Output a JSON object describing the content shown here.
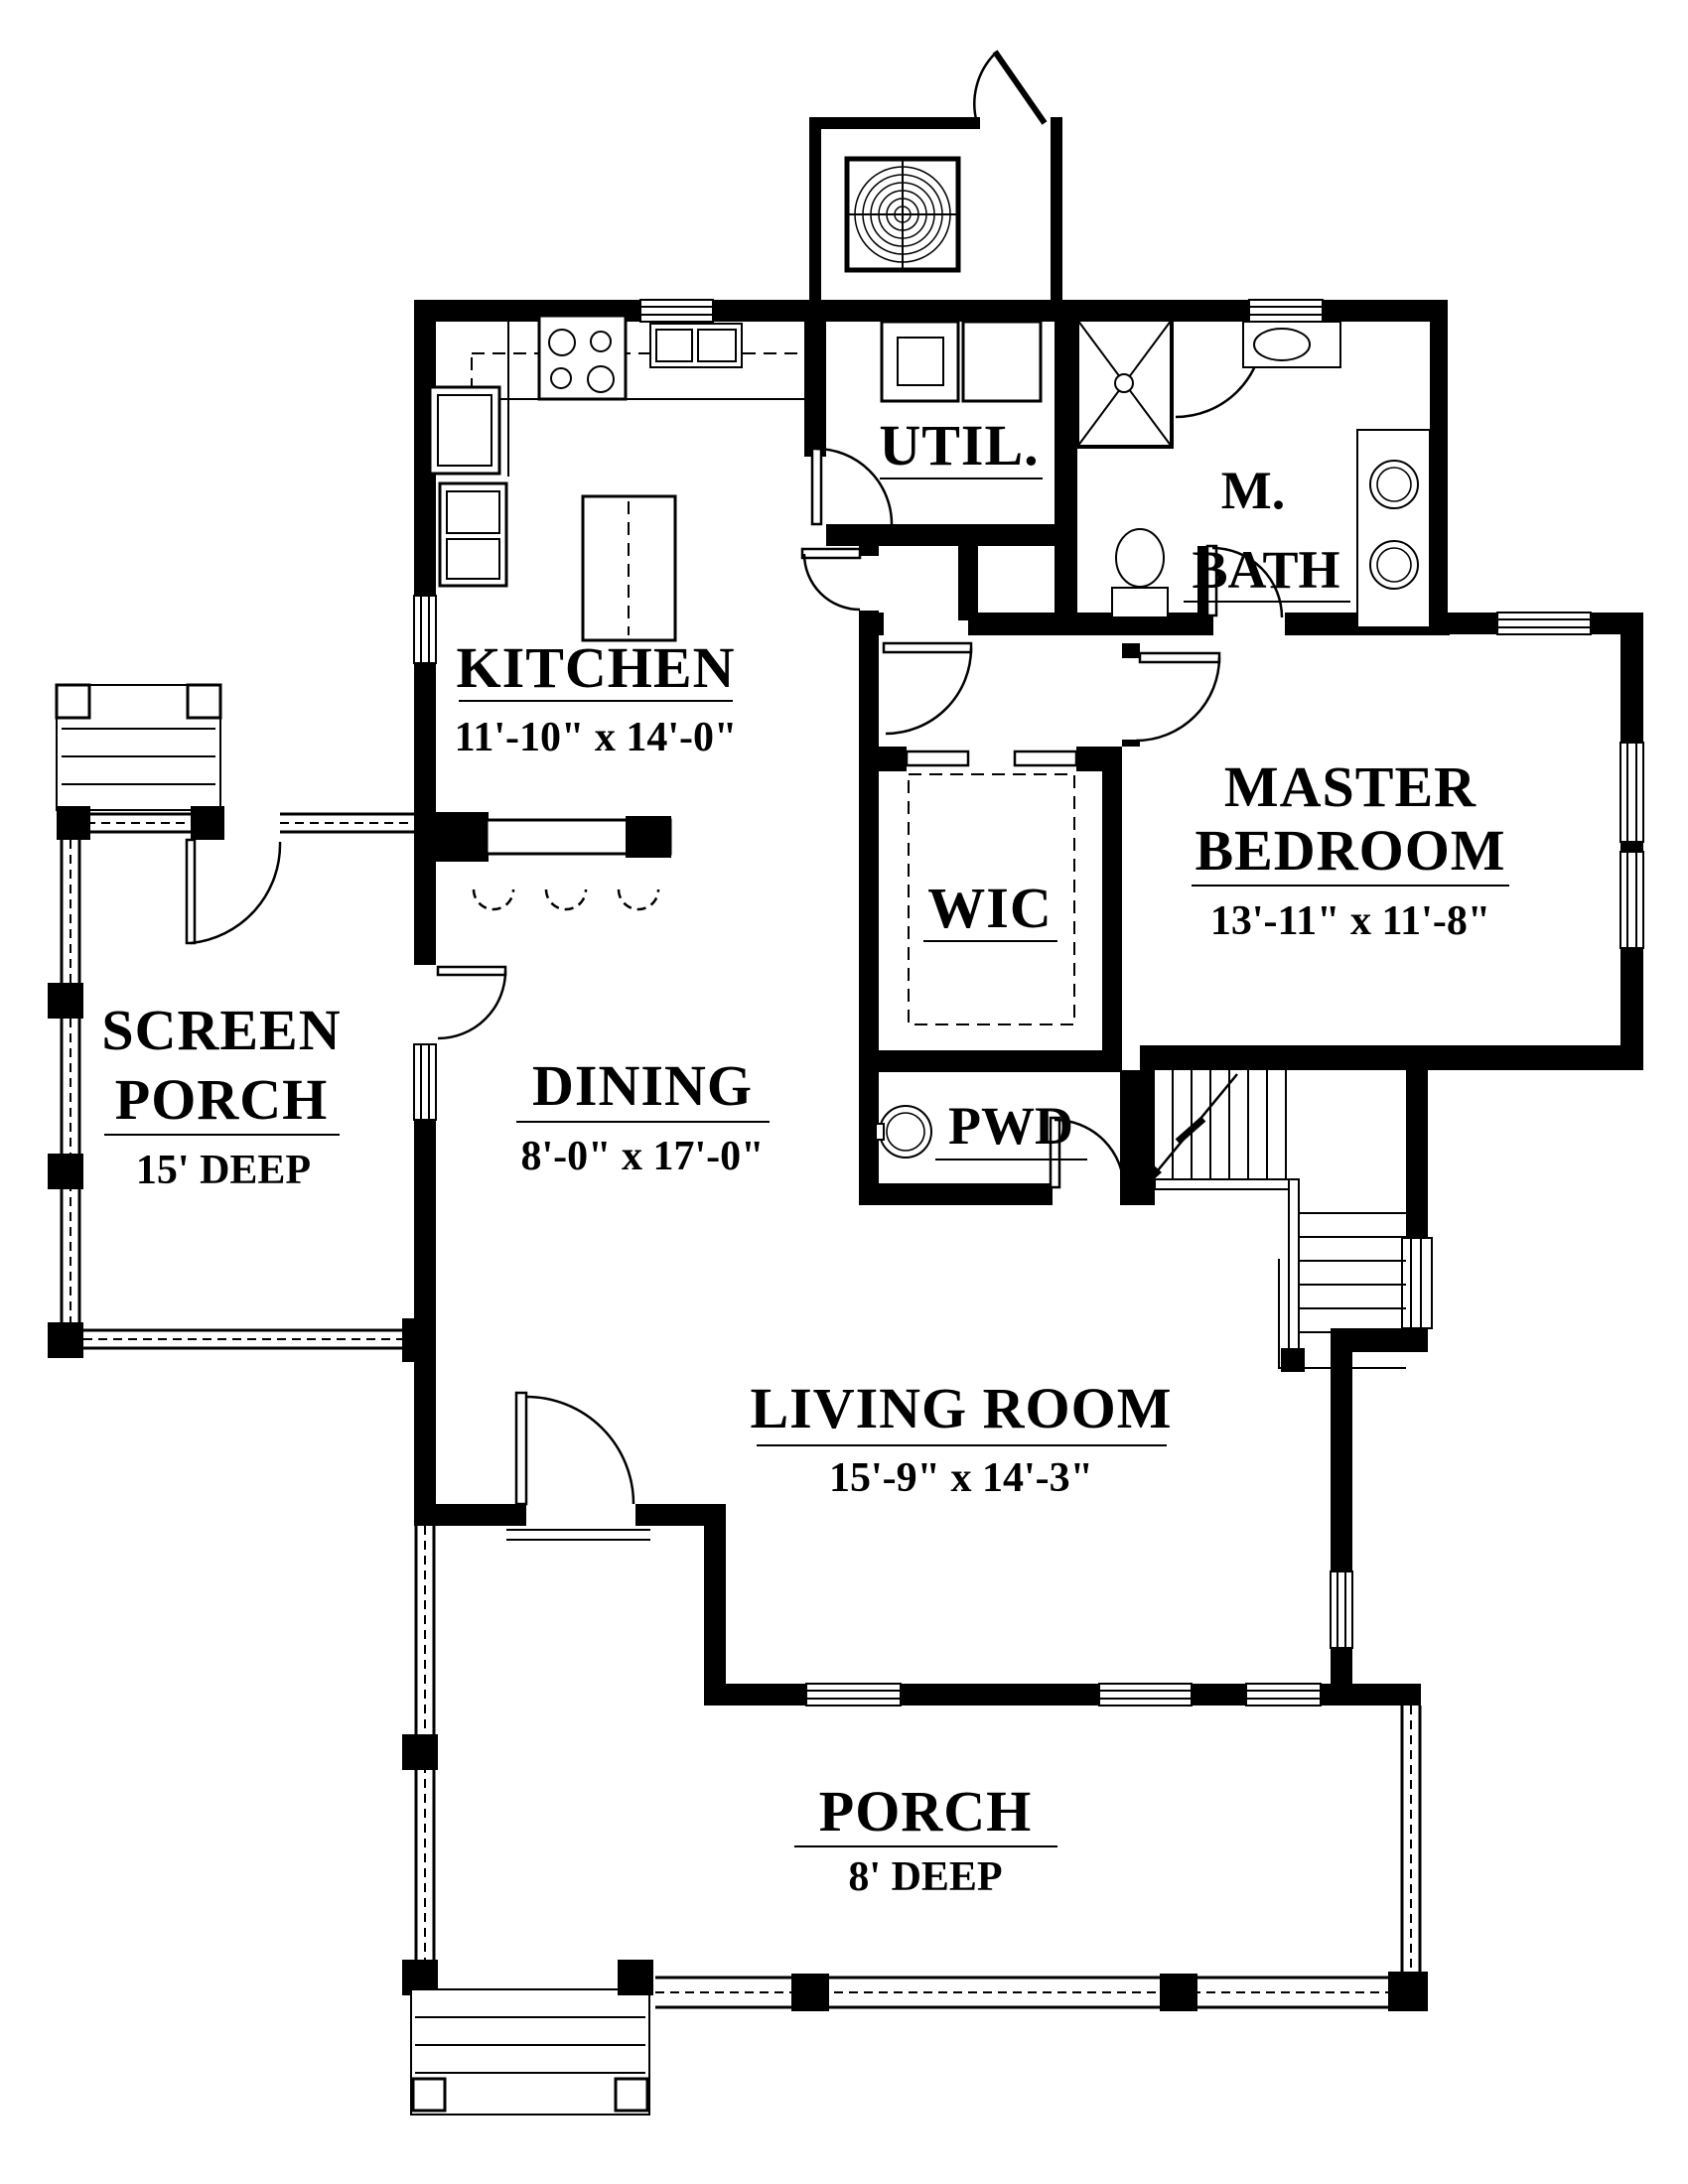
{
  "drawing": {
    "background": "#ffffff",
    "line_color": "#000000"
  },
  "rooms": {
    "kitchen": {
      "name": "KITCHEN",
      "dims": "11'-10\" x 14'-0\""
    },
    "util": {
      "name": "UTIL."
    },
    "master_bath": {
      "name_line1": "M.",
      "name_line2": "BATH"
    },
    "master_bedroom": {
      "name_line1": "MASTER",
      "name_line2": "BEDROOM",
      "dims": "13'-11\" x 11'-8\""
    },
    "wic": {
      "name": "WIC"
    },
    "screen_porch": {
      "name_line1": "SCREEN",
      "name_line2": "PORCH",
      "depth": "15' DEEP"
    },
    "dining": {
      "name": "DINING",
      "dims": "8'-0\" x 17'-0\""
    },
    "pwd": {
      "name": "PWD"
    },
    "living_room": {
      "name": "LIVING ROOM",
      "dims": "15'-9\" x 14'-3\""
    },
    "porch": {
      "name": "PORCH",
      "depth": "8' DEEP"
    }
  }
}
